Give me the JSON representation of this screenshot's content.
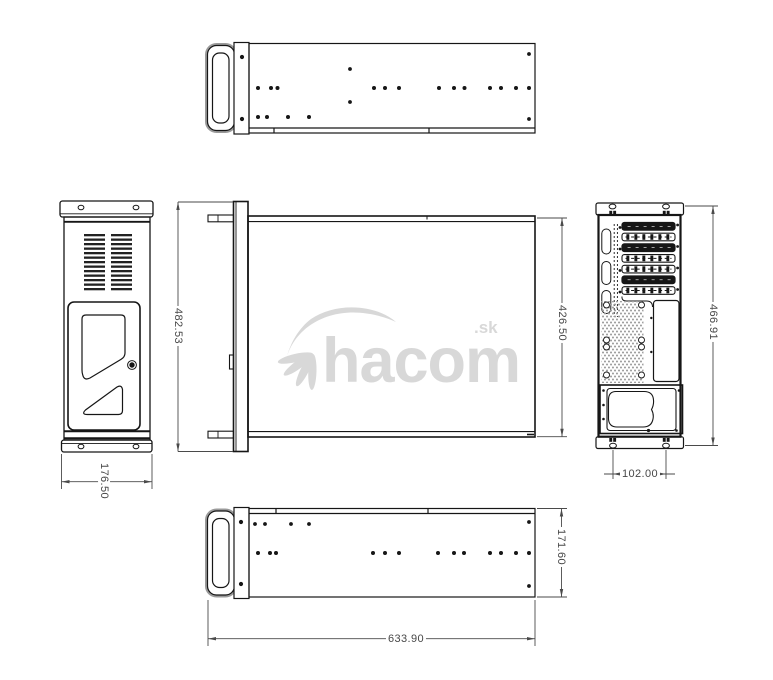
{
  "colors": {
    "background": "#ffffff",
    "line": "#161616",
    "dimension_text": "#474747",
    "watermark": "#d8d8d8",
    "mesh_vent": "#9e9e9e"
  },
  "watermark": {
    "brand": "hacom",
    "tld": ".sk"
  },
  "dimensions": {
    "front_panel_height": "482.53",
    "chassis_body_height": "426.50",
    "rear_panel_height": "466.91",
    "front_panel_width": "176.50",
    "rear_foot_hole_spacing": "102.00",
    "chassis_body_width": "171.60",
    "chassis_depth": "633.90"
  }
}
